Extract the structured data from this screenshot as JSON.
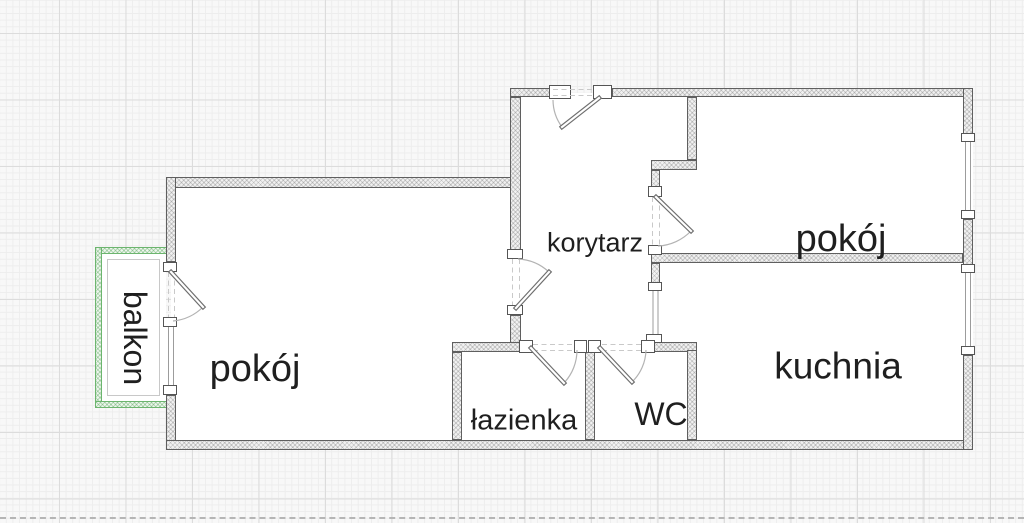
{
  "plan": {
    "title": "apartment floor plan",
    "rooms": [
      {
        "id": "balkon",
        "label": "balkon"
      },
      {
        "id": "pokoj_left",
        "label": "pokój"
      },
      {
        "id": "korytarz",
        "label": "korytarz"
      },
      {
        "id": "pokoj_right",
        "label": "pokój"
      },
      {
        "id": "kuchnia",
        "label": "kuchnia"
      },
      {
        "id": "lazienka",
        "label": "łazienka"
      },
      {
        "id": "wc",
        "label": "WC"
      }
    ],
    "colors": {
      "background": "#f8f8f8",
      "grid_minor": "#ededed",
      "grid_major": "#dcdcdc",
      "wall_fill": "#f1f1f1",
      "wall_border": "#5f5f5f",
      "balcony_green": "#6cb56e",
      "label_text": "#1f1f1f"
    }
  }
}
